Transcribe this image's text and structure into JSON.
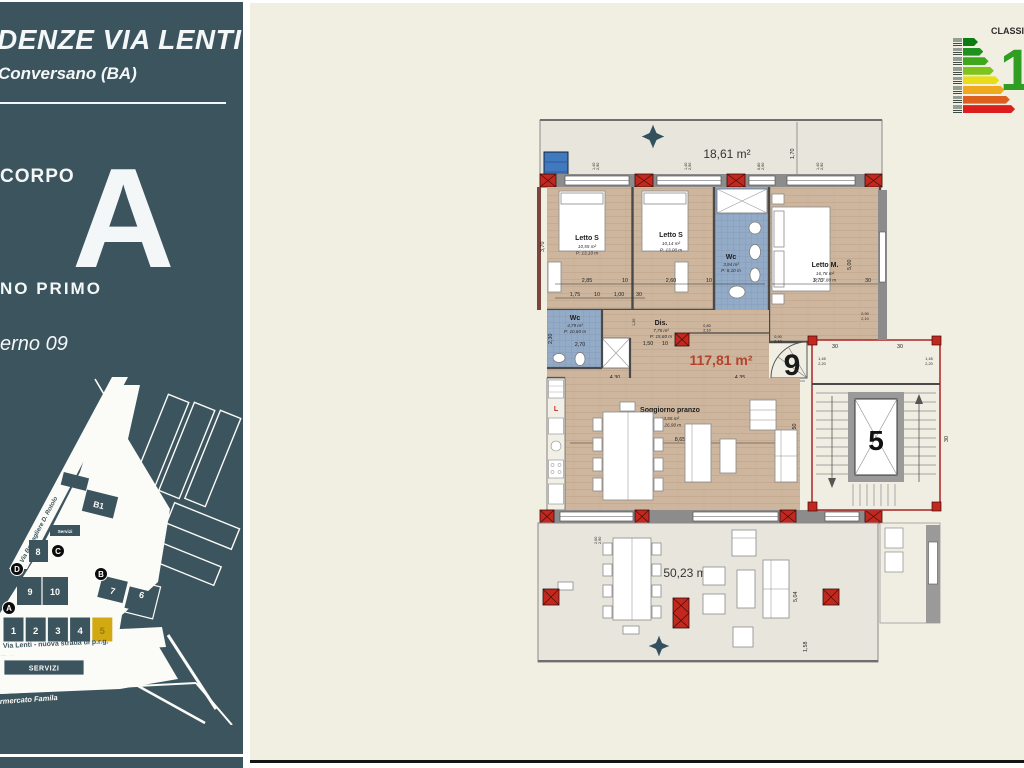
{
  "colors": {
    "sidebar_bg": "#3C545E",
    "panel_bg": "#F1EFE2",
    "highlight_unit": "#D2A913",
    "area_red": "#B5432C",
    "energy_digit_green": "#2F9E23"
  },
  "sidebar": {
    "title": "DENZE VIA LENTI",
    "subtitle": "Conversano (BA)",
    "corpo_label": "CORPO",
    "corpo_letter": "A",
    "piano": "NO PRIMO",
    "interno": "erno 09",
    "map": {
      "street_diagonal": "Via Bersagliere D. Rotolo",
      "block_b1": "B1",
      "servizi_small": "Servizi",
      "building_8": "8",
      "building_9": "9",
      "building_10": "10",
      "building_7": "7",
      "building_6": "6",
      "marker_a": "A",
      "marker_b": "B",
      "marker_c": "C",
      "marker_d": "D",
      "units": [
        "1",
        "2",
        "3",
        "4",
        "5"
      ],
      "highlighted_unit": "5",
      "street_main": "Via Lenti - nuova strada di p.r.g.",
      "servizi_box": "SERVIZI",
      "familia": "rmercato Famila"
    }
  },
  "energy": {
    "label": "CLASSI",
    "big_digit": "1",
    "bar_colors": [
      "#0C7C12",
      "#1E9121",
      "#3DA81C",
      "#7EC41B",
      "#E8DD16",
      "#F0A81C",
      "#DD5F1E",
      "#DC1F1C"
    ]
  },
  "plan": {
    "terrace_top_area": "18,61 m²",
    "terrace_bottom_area": "50,23 m²",
    "total_area": "117,81 m²",
    "unit_number": "9",
    "stair_number": "5",
    "kitchen_letter": "L",
    "rooms": {
      "letto_s1": {
        "name": "Letto S",
        "area": "10,55 m²",
        "perimeter": "P: 13,10 m"
      },
      "letto_s2": {
        "name": "Letto S",
        "area": "10,14 m²",
        "perimeter": "P: 13,00 m"
      },
      "wc_top": {
        "name": "Wc",
        "area": "3,94 m²",
        "perimeter": "P: 8,10 m"
      },
      "letto_m": {
        "name": "Letto M.",
        "area": "16,78 m²",
        "perimeter": "P: 17,80 m"
      },
      "wc_entry": {
        "name": "Wc",
        "area": "4,79 m²",
        "perimeter": "P: 10,60 m"
      },
      "dis": {
        "name": "Dis.",
        "area": "7,75 m²",
        "perimeter": "P: 15,60 m"
      },
      "soggiorno": {
        "name": "Soggiorno pranzo",
        "area": "43,55 m²",
        "perimeter": "P: 26,90 m"
      }
    },
    "dims": {
      "d170": "1,70",
      "d285": "2,85",
      "d260": "2,60",
      "d10": "10",
      "d175": "1,75",
      "d100": "1,00",
      "d30": "30",
      "d370": "3,70",
      "d500": "5,00",
      "d270": "2,70",
      "d230": "2,30",
      "d150": "1,50",
      "d430": "4,30",
      "d435": "4,35",
      "d865": "8,65",
      "d550": "5,50",
      "d504": "5,04",
      "d158": "1,58",
      "d200": "2,00",
      "d290": "2,90",
      "d140": "1,40",
      "d090": "0,90",
      "d210": "2,10",
      "d080": "0,80",
      "d120": "1,20",
      "d145": "1,45",
      "d220": "2,20"
    }
  }
}
